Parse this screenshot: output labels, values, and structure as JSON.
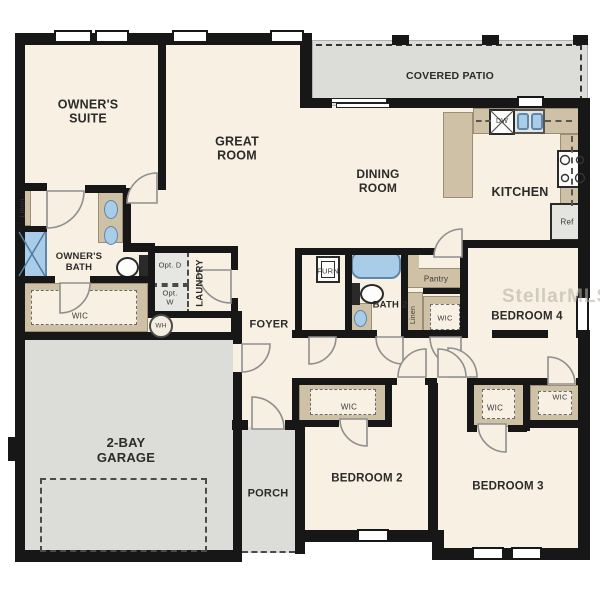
{
  "watermark": "StellarMLS",
  "labels": {
    "owners_suite": "OWNER'S SUITE",
    "great_room": "GREAT ROOM",
    "covered_patio": "COVERED PATIO",
    "dining_room": "DINING ROOM",
    "kitchen": "KITCHEN",
    "owners_bath": "OWNER'S BATH",
    "laundry": "LAUNDRY",
    "foyer": "FOYER",
    "bath_2": "BATH 2",
    "bedroom_2": "BEDROOM 2",
    "bedroom_3": "BEDROOM 3",
    "bedroom_4": "BEDROOM 4",
    "garage": "2-BAY GARAGE",
    "porch": "PORCH",
    "linen_owner": "Linen",
    "linen_hall": "Linen",
    "pantry": "Pantry",
    "wic_owner": "WIC",
    "wic_hall": "WIC",
    "wic_bedroom_2": "WIC",
    "wic_bedroom_3": "WIC",
    "wic_bedroom_4": "WIC",
    "furnace": "FURN",
    "water_heater": "WH",
    "dishwasher": "DW",
    "refrigerator": "Ref",
    "optional_dryer": "Opt. D",
    "optional_washer": "Opt. W"
  },
  "colors": {
    "floor": "#f8f0e2",
    "exterior_surface": "#dcdcd9",
    "cabinetry": "#cfc1a6",
    "wall": "#171717",
    "fixture_blue": "#a9cce9"
  }
}
